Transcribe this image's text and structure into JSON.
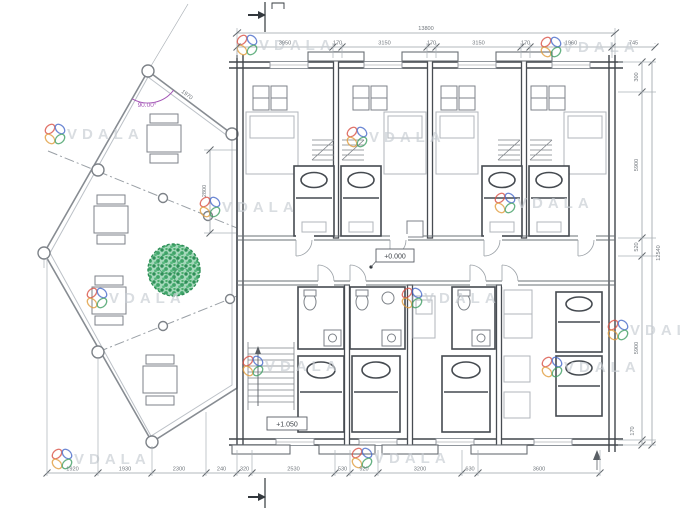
{
  "watermark": {
    "text": "VDALA",
    "logo_colors": [
      "#d94f43",
      "#4668c9",
      "#e09c3c",
      "#3f9e63"
    ],
    "positions": [
      [
        247,
        45
      ],
      [
        551,
        47
      ],
      [
        55,
        134
      ],
      [
        357,
        137
      ],
      [
        505,
        203
      ],
      [
        210,
        207
      ],
      [
        97,
        298
      ],
      [
        412,
        298
      ],
      [
        618,
        330
      ],
      [
        253,
        366
      ],
      [
        552,
        367
      ],
      [
        62,
        459
      ],
      [
        362,
        458
      ]
    ]
  },
  "levels": {
    "main": "+0.000",
    "stairs": "+1.050"
  },
  "angle": {
    "label": "90.00°"
  },
  "dims": {
    "top_total": {
      "label": "13800"
    },
    "right_total": {
      "label": "12540"
    },
    "top_chain": {
      "y": 47,
      "ticks": [
        237,
        333,
        342,
        427,
        436,
        521,
        530,
        612,
        655
      ],
      "labels": [
        "3950",
        "170",
        "3150",
        "170",
        "3150",
        "170",
        "1960",
        "745"
      ]
    },
    "bottom_chain": {
      "y": 473,
      "ticks": [
        47,
        98,
        152,
        206,
        237,
        252,
        335,
        350,
        378,
        462,
        478,
        600
      ],
      "labels": [
        "1920",
        "1930",
        "2300",
        "240",
        "320",
        "2530",
        "530",
        "920",
        "3200",
        "630",
        "3600"
      ]
    },
    "right_chain": {
      "x": 642,
      "ticks": [
        62,
        92,
        238,
        256,
        440,
        445
      ],
      "labels": [
        "300",
        "5900",
        "520",
        "5900",
        ""
      ]
    },
    "left_chain": {
      "label": "2800"
    },
    "deck_edge": {
      "label": "1970"
    },
    "threshold": {
      "label": "170"
    }
  }
}
